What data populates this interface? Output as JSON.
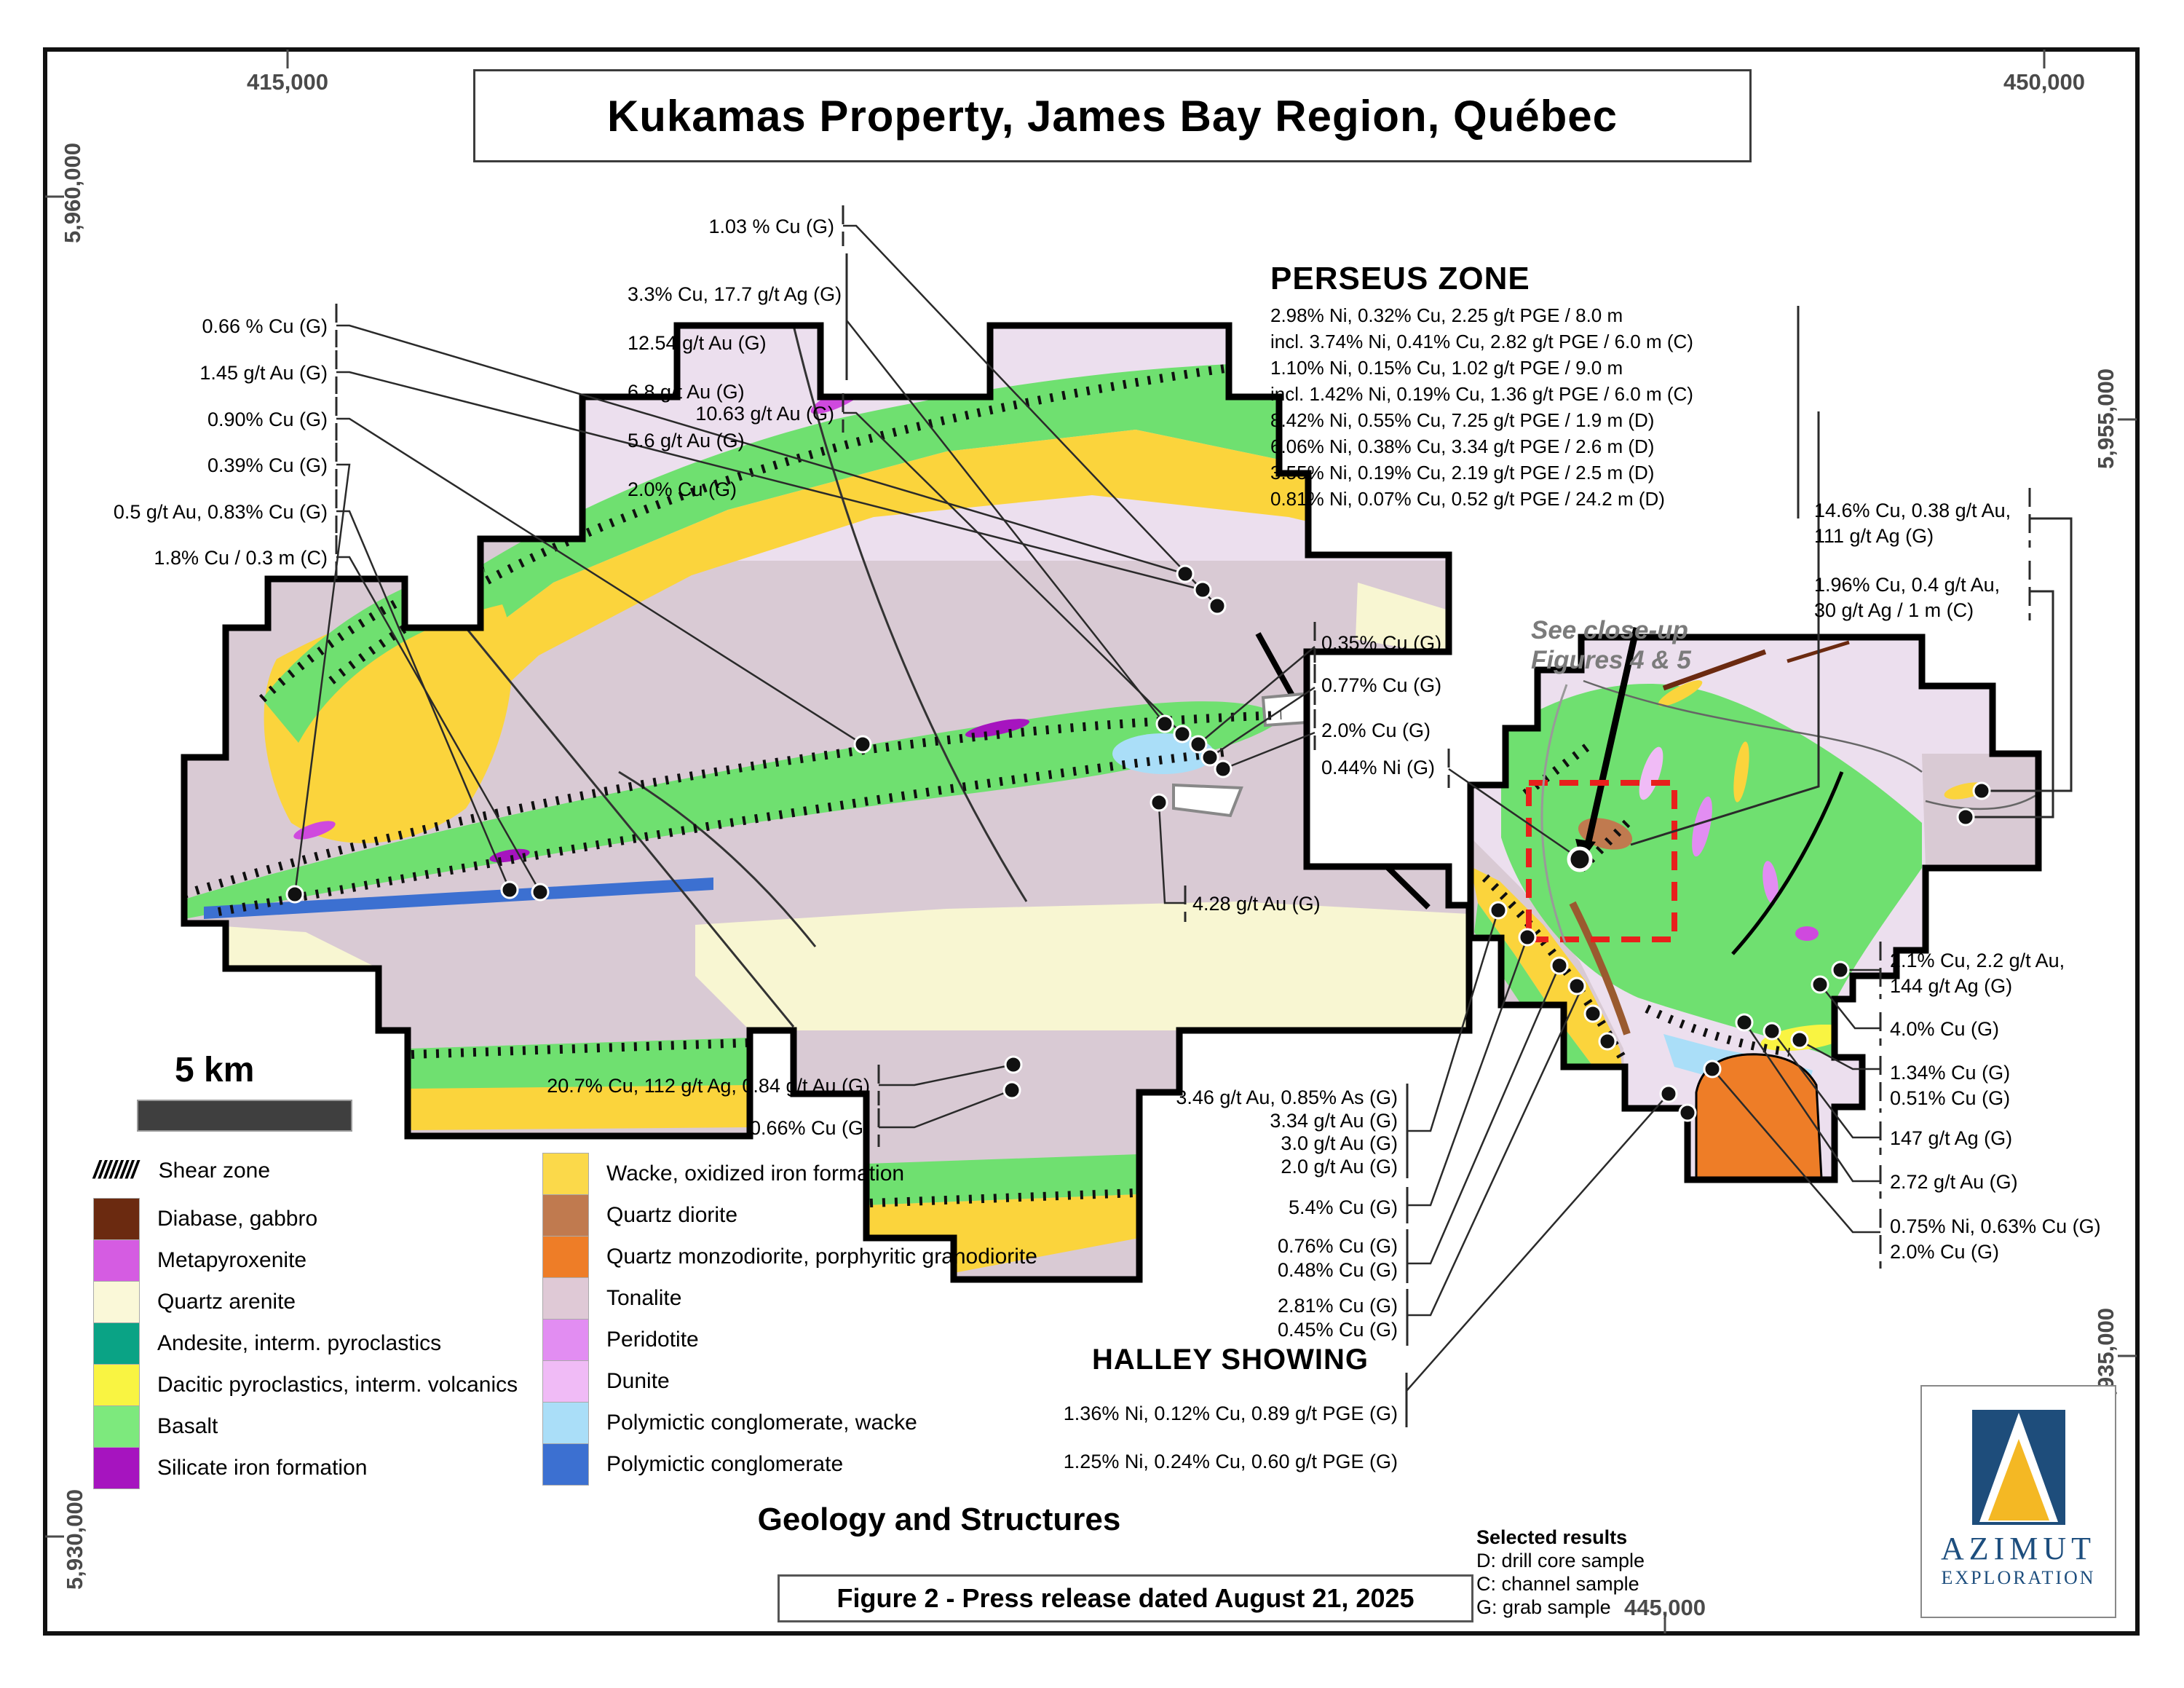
{
  "title": "Kukamas Property, James Bay Region, Québec",
  "frame": {
    "top_left_easting": "415,000",
    "top_right_easting": "450,000",
    "bottom_easting": "445,000",
    "left_top_northing": "5,960,000",
    "right_top_northing": "5,955,000",
    "right_bottom_northing": "5,935,000",
    "left_bottom_northing": "5,930,000"
  },
  "scale": {
    "label": "5 km"
  },
  "zones": {
    "perseus": {
      "title": "PERSEUS ZONE",
      "results": [
        "2.98% Ni, 0.32% Cu, 2.25 g/t PGE / 8.0 m",
        "incl. 3.74% Ni, 0.41% Cu, 2.82 g/t PGE / 6.0 m (C)",
        "1.10% Ni, 0.15% Cu, 1.02 g/t PGE / 9.0 m",
        "incl. 1.42% Ni, 0.19% Cu, 1.36 g/t PGE / 6.0 m (C)",
        "8.42% Ni, 0.55% Cu, 7.25 g/t PGE / 1.9 m (D)",
        "6.06% Ni, 0.38% Cu, 3.34 g/t PGE / 2.6 m (D)",
        "3.55% Ni, 0.19% Cu, 2.19 g/t PGE / 2.5 m (D)",
        "0.81% Ni, 0.07% Cu, 0.52 g/t PGE / 24.2 m (D)"
      ]
    },
    "halley": {
      "title": "HALLEY SHOWING",
      "results": [
        "1.36% Ni, 0.12% Cu, 0.89 g/t PGE (G)",
        "1.25% Ni, 0.24% Cu, 0.60 g/t PGE (G)"
      ]
    },
    "close_up_note": "See close-up\nFigures 4 & 5"
  },
  "sample_labels": {
    "west": [
      "0.66 % Cu (G)",
      "1.45 g/t Au (G)",
      "0.90% Cu (G)",
      "0.39% Cu (G)",
      "0.5 g/t Au, 0.83% Cu (G)",
      "1.8% Cu / 0.3 m (C)"
    ],
    "north_single_top": "1.03 % Cu (G)",
    "north_group": [
      "3.3% Cu, 17.7 g/t Ag (G)",
      "12.54 g/t Au (G)",
      "6.8 g/t Au (G)",
      "5.6 g/t Au (G)",
      "2.0% Cu (G)"
    ],
    "north_single_bottom": "10.63 g/t Au (G)",
    "center": [
      "0.35% Cu (G)",
      "0.77% Cu (G)",
      "2.0% Cu (G)",
      "0.44% Ni (G)"
    ],
    "center_single": "4.28 g/t Au (G)",
    "southwest": [
      "20.7% Cu, 112 g/t Ag, 0.84 g/t Au (G)",
      "0.66% Cu (G)"
    ],
    "east_top": [
      "14.6% Cu, 0.38 g/t Au,\n111 g/t Ag (G)",
      "1.96% Cu, 0.4 g/t Au,\n30 g/t Ag / 1 m (C)"
    ],
    "east_side": [
      "2.1% Cu, 2.2 g/t Au,\n144 g/t Ag (G)",
      "4.0% Cu (G)",
      "1.34% Cu (G)\n0.51% Cu (G)",
      "147 g/t Ag (G)",
      "2.72 g/t Au (G)",
      "0.75% Ni, 0.63% Cu (G)\n2.0% Cu (G)"
    ],
    "south": [
      "3.46 g/t Au, 0.85% As (G)\n3.34 g/t Au (G)\n3.0 g/t Au (G)\n2.0 g/t Au (G)",
      "5.4% Cu (G)",
      "0.76% Cu (G)\n0.48% Cu (G)",
      "2.81% Cu (G)\n0.45% Cu (G)"
    ]
  },
  "legend": {
    "shear_symbol": "////////",
    "shear_label": "Shear zone",
    "left": [
      {
        "label": "Diabase, gabbro",
        "color": "#6b2a10"
      },
      {
        "label": "Metapyroxenite",
        "color": "#d55ce2"
      },
      {
        "label": "Quartz arenite",
        "color": "#faf8d8"
      },
      {
        "label": "Andesite, interm. pyroclastics",
        "color": "#0aa385"
      },
      {
        "label": "Dacitic pyroclastics, interm. volcanics",
        "color": "#f9f442"
      },
      {
        "label": "Basalt",
        "color": "#7de97d"
      },
      {
        "label": "Silicate iron formation",
        "color": "#a614bf"
      }
    ],
    "right": [
      {
        "label": "Wacke, oxidized iron formation",
        "color": "#fbd94a"
      },
      {
        "label": "Quartz diorite",
        "color": "#c07a4f"
      },
      {
        "label": "Quartz monzodiorite, porphyritic granodiorite",
        "color": "#ee7d27"
      },
      {
        "label": "Tonalite",
        "color": "#dfc9d6"
      },
      {
        "label": "Peridotite",
        "color": "#e28df2"
      },
      {
        "label": "Dunite",
        "color": "#f0bbf6"
      },
      {
        "label": "Polymictic conglomerate, wacke",
        "color": "#aadef8"
      },
      {
        "label": "Polymictic conglomerate",
        "color": "#3c70d1"
      }
    ]
  },
  "footer": {
    "map_subtitle": "Geology and Structures",
    "figure_caption": "Figure 2 - Press release dated August 21, 2025",
    "selected_results_title": "Selected results",
    "selected_results": [
      "D: drill core sample",
      "C: channel sample",
      "G: grab sample"
    ]
  },
  "logo": {
    "company": "AZIMUT",
    "division": "EXPLORATION"
  },
  "colors": {
    "accent_red": "#e8201c",
    "tonalite_main": "#d9cad4",
    "tonalite_light": "#ecdfee",
    "basalt": "#6fe070",
    "wacke": "#fbd43c",
    "quartz_arenite": "#f8f6d2",
    "orange_monzodiorite": "#ee7d27",
    "logo_blue": "#1e4d7b",
    "logo_yellow": "#f4b824"
  }
}
